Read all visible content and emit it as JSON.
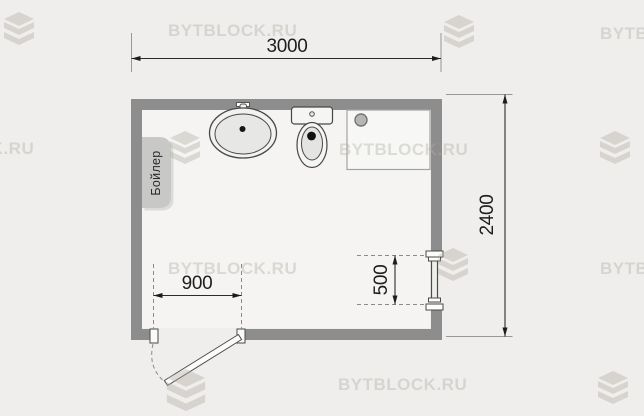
{
  "watermark": {
    "text": "BYTBLOCK.RU"
  },
  "plan": {
    "type": "bathroom-floor-plan",
    "dimensions": {
      "room_width_mm": "3000",
      "room_depth_mm": "2400",
      "door_width_mm": "900",
      "towel_rail_mm": "500"
    },
    "labels": {
      "boiler": "Бойлер"
    },
    "fixtures": [
      "boiler",
      "sink",
      "toilet",
      "shower-tray",
      "towel-rail",
      "door"
    ],
    "colors": {
      "background": "#efeeec",
      "floor": "#f5f4f2",
      "wall": "#8d8d8d",
      "dimension_text": "#1e1e1e",
      "boiler_fill": "#c8c8c6",
      "watermark": "#b4afa7"
    }
  }
}
